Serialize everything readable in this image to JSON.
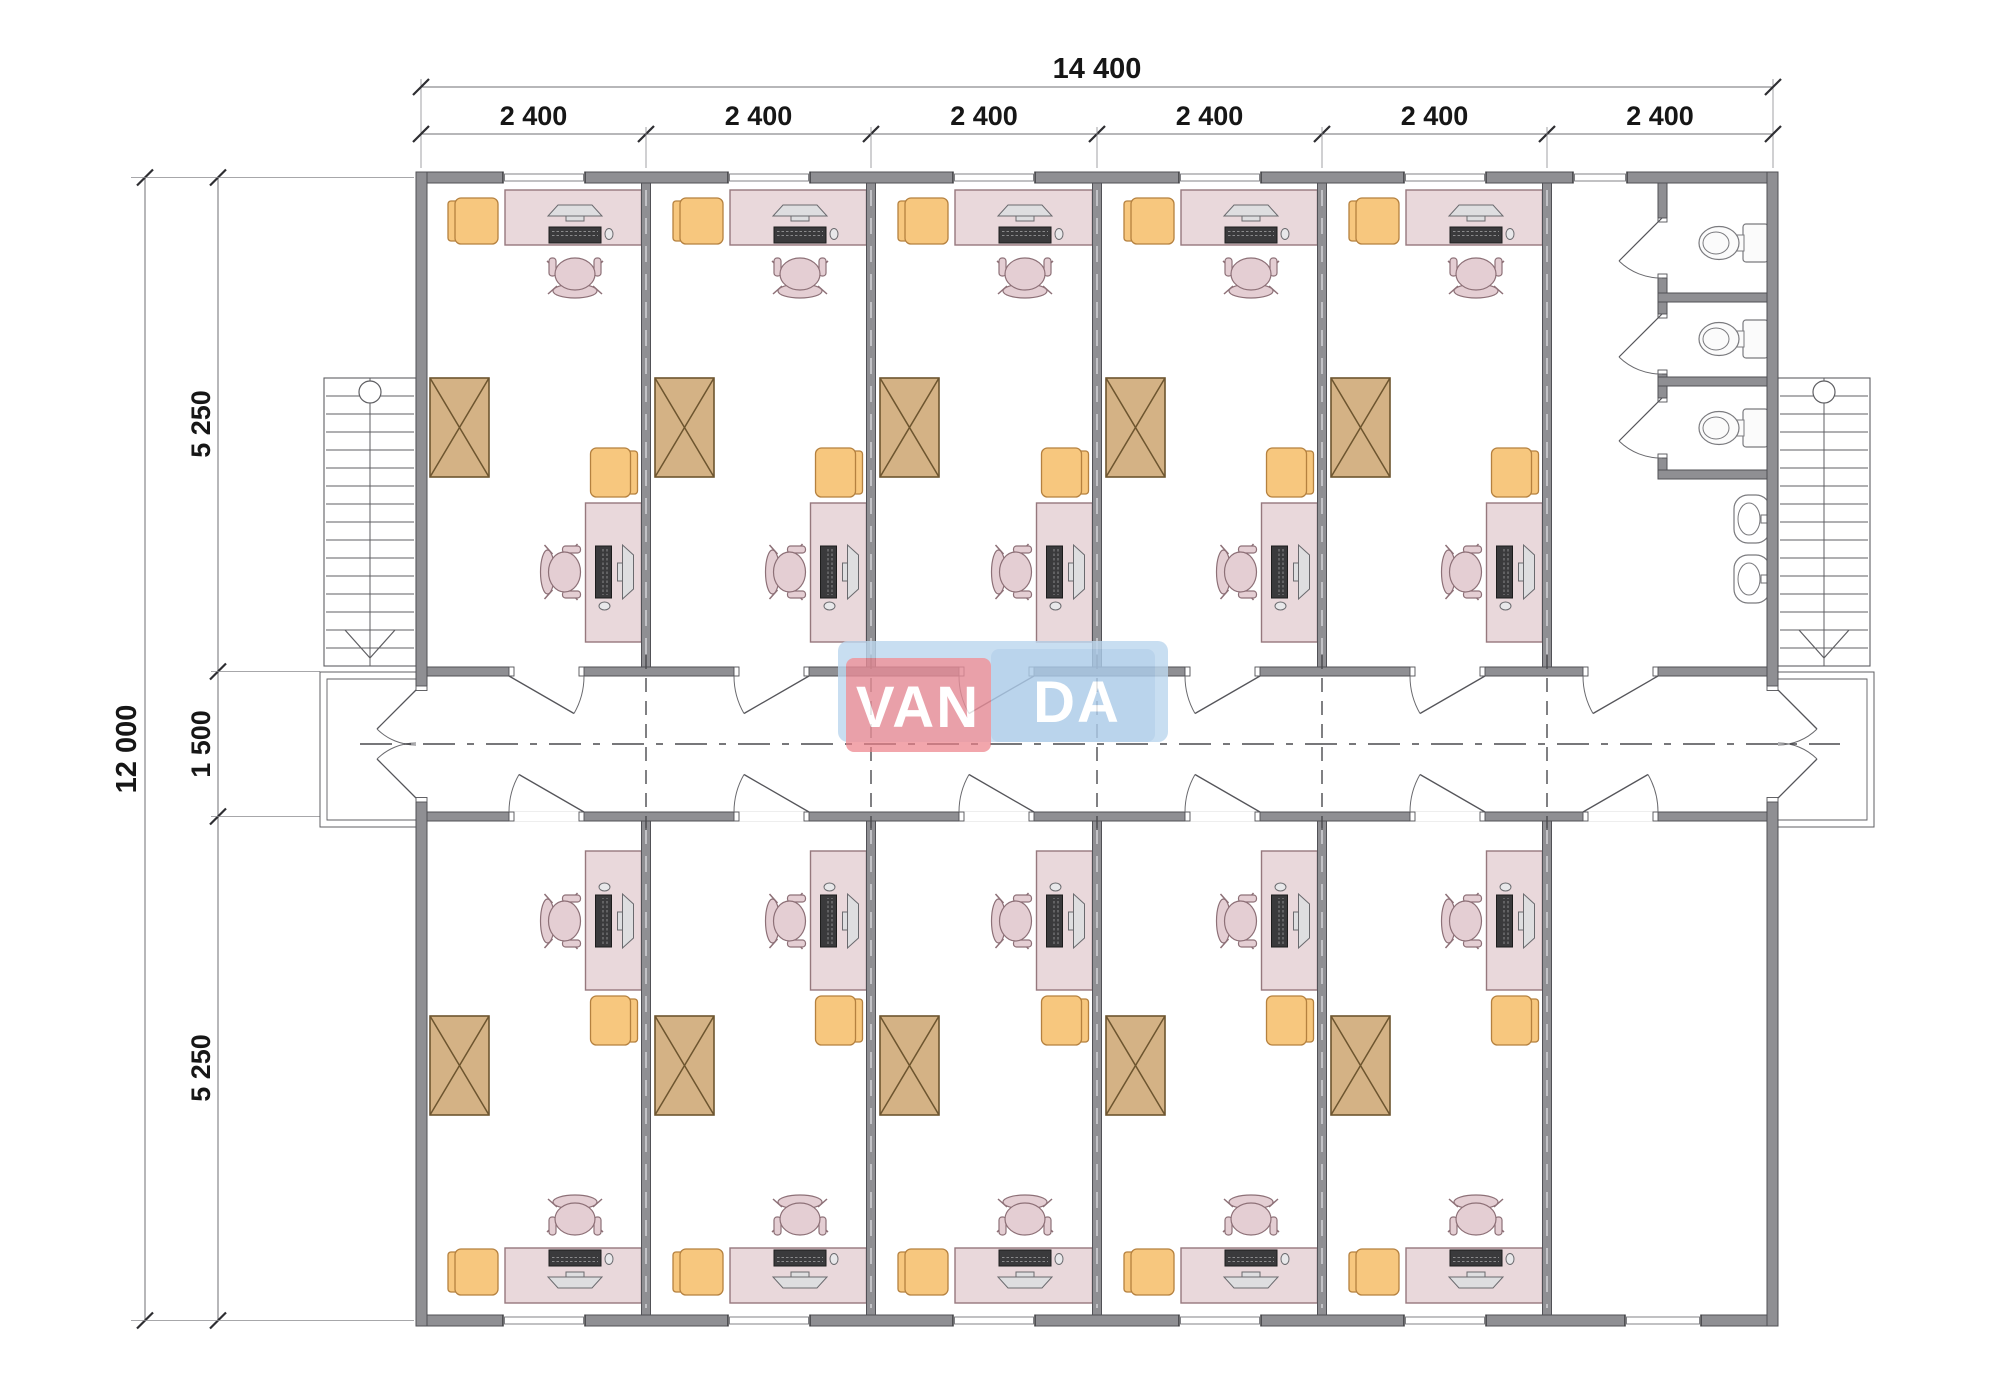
{
  "page": {
    "background": "#ffffff"
  },
  "logo": {
    "text_left": "VAN",
    "text_right": "DA",
    "red": "#ec7f87",
    "blue": "#a9c9e7",
    "shadow_blue": "#bdd7ee",
    "text_color": "#ffffff"
  },
  "dimensions": {
    "top_total": "14 400",
    "top_segments": [
      "2 400",
      "2 400",
      "2 400",
      "2 400",
      "2 400",
      "2 400"
    ],
    "left_total": "12 000",
    "left_segments": [
      "5 250",
      "1 500",
      "5 250"
    ]
  },
  "plan": {
    "office_bays_top": 5,
    "office_bays_bottom": 5,
    "toilet_stalls": 3,
    "sinks": 2,
    "staircases": 2,
    "colors": {
      "wall_fill": "#8f8f93",
      "wall_stroke": "#515156",
      "desk_fill": "#e9d8db",
      "desk_stroke": "#96787d",
      "chair_fill": "#e4ced3",
      "chair_stroke": "#8d7077",
      "armchair_fill": "#f7c77e",
      "armchair_stroke": "#b5813f",
      "cabinet_fill": "#d4b285",
      "cabinet_stroke": "#6d552f",
      "fixture_stroke": "#7a7a7e",
      "screen_dark": "#3a3a3c",
      "line": "#5f5f63",
      "thin": "#8a8a8e",
      "dim_text": "#161616",
      "dim_line": "#6f6f73",
      "tick": "#2e2e32"
    }
  }
}
